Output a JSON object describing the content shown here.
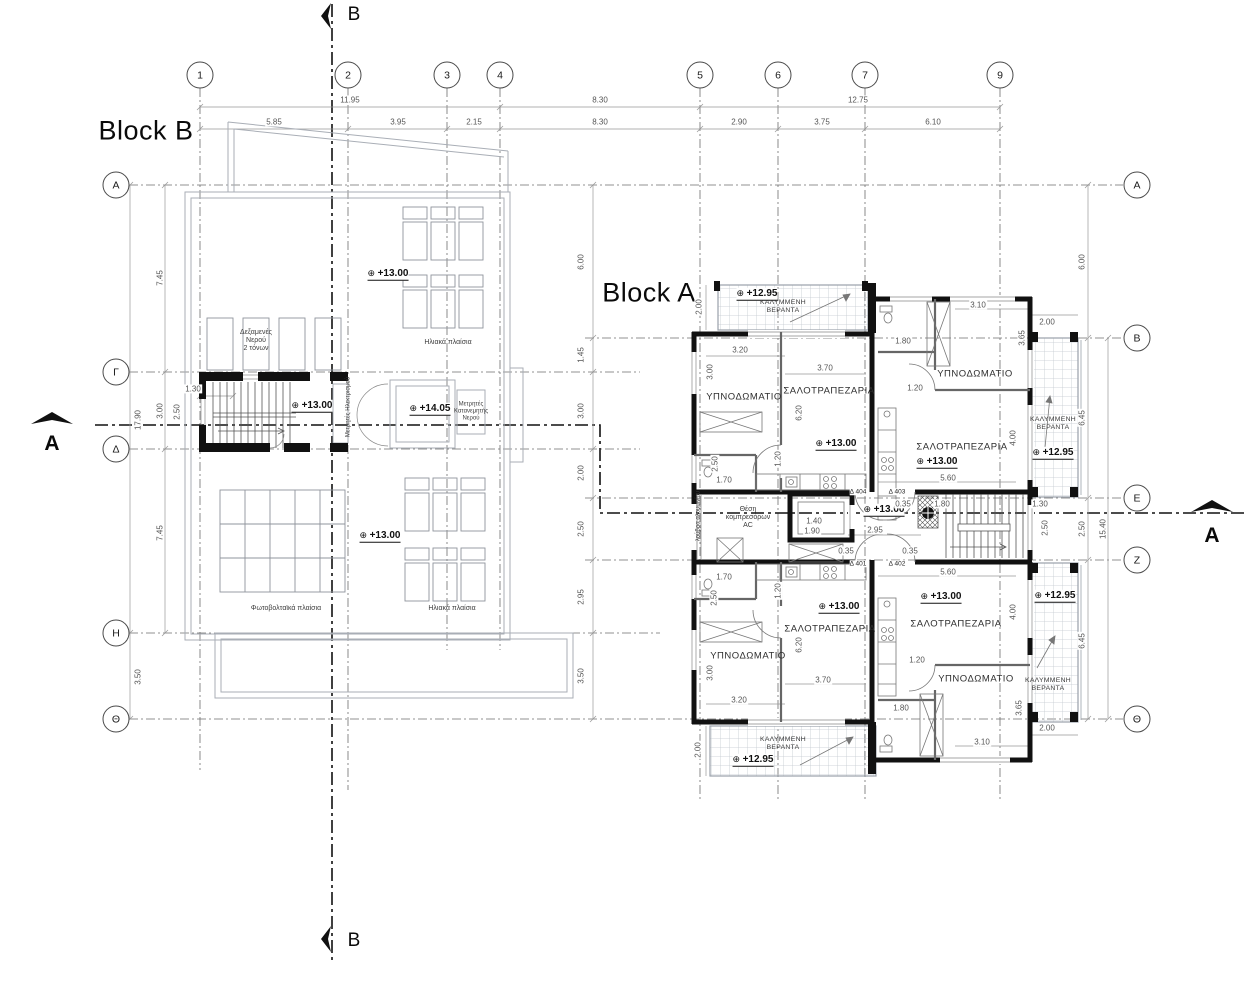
{
  "drawing": {
    "type": "roof / fourth floor plan",
    "line_color": "#4a4a4a",
    "wall_color": "#111111",
    "hatch_color": "#c3c9d0"
  },
  "titles": [
    {
      "t": "Block B",
      "x": 146,
      "y": 131,
      "cls": "big"
    },
    {
      "t": "Block A",
      "x": 649,
      "y": 293,
      "cls": "big"
    }
  ],
  "section_letters": [
    {
      "t": "B",
      "x": 354,
      "y": 15,
      "cls": "sec"
    },
    {
      "t": "B",
      "x": 354,
      "y": 941,
      "cls": "sec"
    },
    {
      "t": "A",
      "x": 52,
      "y": 444,
      "cls": "sec secb"
    },
    {
      "t": "A",
      "x": 1212,
      "y": 536,
      "cls": "sec secb"
    }
  ],
  "grid": {
    "columns": [
      {
        "label": "1",
        "x": 200
      },
      {
        "label": "2",
        "x": 348
      },
      {
        "label": "3",
        "x": 447
      },
      {
        "label": "4",
        "x": 500
      },
      {
        "label": "5",
        "x": 700
      },
      {
        "label": "6",
        "x": 778
      },
      {
        "label": "7",
        "x": 865
      },
      {
        "label": "9",
        "x": 1000
      }
    ],
    "rows_left": [
      {
        "label": "A",
        "y": 185
      },
      {
        "label": "Γ",
        "y": 372
      },
      {
        "label": "Δ",
        "y": 449
      },
      {
        "label": "H",
        "y": 633
      },
      {
        "label": "Θ",
        "y": 719
      }
    ],
    "rows_right": [
      {
        "label": "A",
        "y": 185
      },
      {
        "label": "B",
        "y": 338
      },
      {
        "label": "E",
        "y": 498
      },
      {
        "label": "Z",
        "y": 560
      },
      {
        "label": "Θ",
        "y": 719
      }
    ]
  },
  "labels": [
    {
      "t": "11.95",
      "x": 350,
      "y": 100,
      "cls": "dim"
    },
    {
      "t": "8.30",
      "x": 600,
      "y": 100,
      "cls": "dim"
    },
    {
      "t": "12.75",
      "x": 858,
      "y": 100,
      "cls": "dim"
    },
    {
      "t": "5.85",
      "x": 274,
      "y": 122,
      "cls": "dim"
    },
    {
      "t": "3.95",
      "x": 398,
      "y": 122,
      "cls": "dim"
    },
    {
      "t": "2.15",
      "x": 474,
      "y": 122,
      "cls": "dim"
    },
    {
      "t": "8.30",
      "x": 600,
      "y": 122,
      "cls": "dim"
    },
    {
      "t": "2.90",
      "x": 739,
      "y": 122,
      "cls": "dim"
    },
    {
      "t": "3.75",
      "x": 822,
      "y": 122,
      "cls": "dim"
    },
    {
      "t": "6.10",
      "x": 933,
      "y": 122,
      "cls": "dim"
    },
    {
      "t": "17.90",
      "x": 138,
      "y": 420,
      "cls": "dim dimv"
    },
    {
      "t": "3.50",
      "x": 138,
      "y": 677,
      "cls": "dim dimv"
    },
    {
      "t": "7.45",
      "x": 160,
      "y": 278,
      "cls": "dim dimv"
    },
    {
      "t": "3.00",
      "x": 160,
      "y": 411,
      "cls": "dim dimv"
    },
    {
      "t": "2.50",
      "x": 177,
      "y": 412,
      "cls": "dim dimv"
    },
    {
      "t": "7.45",
      "x": 160,
      "y": 533,
      "cls": "dim dimv"
    },
    {
      "t": "1.30",
      "x": 193,
      "y": 389,
      "cls": "dim"
    },
    {
      "t": "6.00",
      "x": 581,
      "y": 262,
      "cls": "dim dimv"
    },
    {
      "t": "1.45",
      "x": 581,
      "y": 355,
      "cls": "dim dimv"
    },
    {
      "t": "3.00",
      "x": 581,
      "y": 411,
      "cls": "dim dimv"
    },
    {
      "t": "2.00",
      "x": 581,
      "y": 473,
      "cls": "dim dimv"
    },
    {
      "t": "2.50",
      "x": 581,
      "y": 529,
      "cls": "dim dimv"
    },
    {
      "t": "2.95",
      "x": 581,
      "y": 597,
      "cls": "dim dimv"
    },
    {
      "t": "3.50",
      "x": 581,
      "y": 676,
      "cls": "dim dimv"
    },
    {
      "t": "6.00",
      "x": 1082,
      "y": 262,
      "cls": "dim dimv"
    },
    {
      "t": "6.45",
      "x": 1082,
      "y": 418,
      "cls": "dim dimv"
    },
    {
      "t": "2.50",
      "x": 1082,
      "y": 529,
      "cls": "dim dimv"
    },
    {
      "t": "6.45",
      "x": 1082,
      "y": 641,
      "cls": "dim dimv"
    },
    {
      "t": "15.40",
      "x": 1103,
      "y": 529,
      "cls": "dim dimv"
    },
    {
      "t": "Δεξαμενές\nΝερού\n2 τόνων",
      "x": 256,
      "y": 341,
      "cls": "note"
    },
    {
      "t": "Ηλιακά πλαίσια",
      "x": 448,
      "y": 343,
      "cls": "note"
    },
    {
      "t": "Ηλιακά πλαίσια",
      "x": 452,
      "y": 609,
      "cls": "note"
    },
    {
      "t": "Φωτοβολταϊκά πλαίσια",
      "x": 286,
      "y": 609,
      "cls": "note"
    },
    {
      "t": "Μετρητές\nΚατανεμητής\nΝερού",
      "x": 471,
      "y": 412,
      "cls": "note sm"
    },
    {
      "t": "Μετρητές Ηλεκτρισμού",
      "x": 349,
      "y": 407,
      "cls": "notev"
    },
    {
      "t": "+13.00",
      "x": 388,
      "y": 274,
      "cls": "level"
    },
    {
      "t": "+13.00",
      "x": 312,
      "y": 406,
      "cls": "level"
    },
    {
      "t": "+14.05",
      "x": 430,
      "y": 409,
      "cls": "level"
    },
    {
      "t": "+13.00",
      "x": 380,
      "y": 536,
      "cls": "level"
    },
    {
      "t": "ΥΠΝΟΔΩΜΑΤΙΟ",
      "x": 744,
      "y": 398,
      "cls": "room"
    },
    {
      "t": "ΣΑΛΟΤΡΑΠΕΖΑΡΙΑ",
      "x": 829,
      "y": 392,
      "cls": "room"
    },
    {
      "t": "ΥΠΝΟΔΩΜΑΤΙΟ",
      "x": 975,
      "y": 375,
      "cls": "room"
    },
    {
      "t": "ΣΑΛΟΤΡΑΠΕΖΑΡΙΑ",
      "x": 962,
      "y": 448,
      "cls": "room"
    },
    {
      "t": "ΥΠΝΟΔΩΜΑΤΙΟ",
      "x": 748,
      "y": 657,
      "cls": "room"
    },
    {
      "t": "ΣΑΛΟΤΡΑΠΕΖΑΡΙΑ",
      "x": 830,
      "y": 630,
      "cls": "room"
    },
    {
      "t": "ΥΠΝΟΔΩΜΑΤΙΟ",
      "x": 976,
      "y": 680,
      "cls": "room"
    },
    {
      "t": "ΣΑΛΟΤΡΑΠΕΖΑΡΙΑ",
      "x": 956,
      "y": 625,
      "cls": "room"
    },
    {
      "t": "ΚΑΛΥΜΜΕΝΗ\nΒΕΡΑΝΤΑ",
      "x": 783,
      "y": 307,
      "cls": "ver"
    },
    {
      "t": "ΚΑΛΥΜΜΕΝΗ\nΒΕΡΑΝΤΑ",
      "x": 783,
      "y": 744,
      "cls": "ver"
    },
    {
      "t": "ΚΑΛΥΜΜΕΝΗ\nΒΕΡΑΝΤΑ",
      "x": 1053,
      "y": 424,
      "cls": "ver"
    },
    {
      "t": "ΚΑΛΥΜΜΕΝΗ\nΒΕΡΑΝΤΑ",
      "x": 1048,
      "y": 685,
      "cls": "ver"
    },
    {
      "t": "Θέση\nκομπρεσόρων\nAC",
      "x": 748,
      "y": 518,
      "cls": "note"
    },
    {
      "t": "λούβρα αλουμινίου",
      "x": 699,
      "y": 516,
      "cls": "notev"
    },
    {
      "t": "Δ 404",
      "x": 858,
      "y": 492,
      "cls": "door"
    },
    {
      "t": "Δ 403",
      "x": 897,
      "y": 492,
      "cls": "door"
    },
    {
      "t": "Δ 401",
      "x": 858,
      "y": 564,
      "cls": "door"
    },
    {
      "t": "Δ 402",
      "x": 897,
      "y": 564,
      "cls": "door"
    },
    {
      "t": "+12.95",
      "x": 757,
      "y": 294,
      "cls": "level"
    },
    {
      "t": "+13.00",
      "x": 836,
      "y": 444,
      "cls": "level"
    },
    {
      "t": "+13.00",
      "x": 937,
      "y": 462,
      "cls": "level"
    },
    {
      "t": "+12.95",
      "x": 1053,
      "y": 453,
      "cls": "level"
    },
    {
      "t": "+13.00",
      "x": 884,
      "y": 510,
      "cls": "level"
    },
    {
      "t": "+13.00",
      "x": 839,
      "y": 607,
      "cls": "level"
    },
    {
      "t": "+13.00",
      "x": 941,
      "y": 597,
      "cls": "level"
    },
    {
      "t": "+12.95",
      "x": 753,
      "y": 760,
      "cls": "level"
    },
    {
      "t": "+12.95",
      "x": 1055,
      "y": 596,
      "cls": "level"
    },
    {
      "t": "2.00",
      "x": 699,
      "y": 307,
      "cls": "dim dimv"
    },
    {
      "t": "3.20",
      "x": 740,
      "y": 350,
      "cls": "dim"
    },
    {
      "t": "3.70",
      "x": 825,
      "y": 368,
      "cls": "dim"
    },
    {
      "t": "3.00",
      "x": 710,
      "y": 372,
      "cls": "dim dimv"
    },
    {
      "t": "6.20",
      "x": 799,
      "y": 413,
      "cls": "dim dimv"
    },
    {
      "t": "1.20",
      "x": 778,
      "y": 459,
      "cls": "dim dimv"
    },
    {
      "t": "2.50",
      "x": 715,
      "y": 464,
      "cls": "dim dimv"
    },
    {
      "t": "1.70",
      "x": 724,
      "y": 480,
      "cls": "dim"
    },
    {
      "t": "1.80",
      "x": 903,
      "y": 341,
      "cls": "dim"
    },
    {
      "t": "3.10",
      "x": 978,
      "y": 305,
      "cls": "dim"
    },
    {
      "t": "3.65",
      "x": 1022,
      "y": 338,
      "cls": "dim dimv"
    },
    {
      "t": "1.20",
      "x": 915,
      "y": 388,
      "cls": "dim"
    },
    {
      "t": "4.00",
      "x": 1013,
      "y": 438,
      "cls": "dim dimv"
    },
    {
      "t": "5.60",
      "x": 948,
      "y": 478,
      "cls": "dim"
    },
    {
      "t": "2.00",
      "x": 1047,
      "y": 322,
      "cls": "dim"
    },
    {
      "t": "1.40",
      "x": 814,
      "y": 521,
      "cls": "dim"
    },
    {
      "t": "1.90",
      "x": 812,
      "y": 531,
      "cls": "dim"
    },
    {
      "t": "2.95",
      "x": 875,
      "y": 530,
      "cls": "dim"
    },
    {
      "t": "0.35",
      "x": 903,
      "y": 504,
      "cls": "dim"
    },
    {
      "t": "1.80",
      "x": 942,
      "y": 504,
      "cls": "dim"
    },
    {
      "t": "0.35",
      "x": 846,
      "y": 551,
      "cls": "dim"
    },
    {
      "t": "0.35",
      "x": 910,
      "y": 551,
      "cls": "dim"
    },
    {
      "t": "1.30",
      "x": 1040,
      "y": 504,
      "cls": "dim"
    },
    {
      "t": "2.50",
      "x": 1045,
      "y": 528,
      "cls": "dim dimv"
    },
    {
      "t": "5.60",
      "x": 948,
      "y": 572,
      "cls": "dim"
    },
    {
      "t": "1.70",
      "x": 724,
      "y": 577,
      "cls": "dim"
    },
    {
      "t": "1.20",
      "x": 778,
      "y": 591,
      "cls": "dim dimv"
    },
    {
      "t": "2.50",
      "x": 714,
      "y": 598,
      "cls": "dim dimv"
    },
    {
      "t": "6.20",
      "x": 799,
      "y": 645,
      "cls": "dim dimv"
    },
    {
      "t": "3.70",
      "x": 823,
      "y": 680,
      "cls": "dim"
    },
    {
      "t": "3.20",
      "x": 739,
      "y": 700,
      "cls": "dim"
    },
    {
      "t": "3.00",
      "x": 710,
      "y": 673,
      "cls": "dim dimv"
    },
    {
      "t": "2.00",
      "x": 698,
      "y": 750,
      "cls": "dim dimv"
    },
    {
      "t": "1.20",
      "x": 917,
      "y": 660,
      "cls": "dim"
    },
    {
      "t": "1.80",
      "x": 901,
      "y": 708,
      "cls": "dim"
    },
    {
      "t": "4.00",
      "x": 1013,
      "y": 612,
      "cls": "dim dimv"
    },
    {
      "t": "3.65",
      "x": 1019,
      "y": 708,
      "cls": "dim dimv"
    },
    {
      "t": "3.10",
      "x": 982,
      "y": 742,
      "cls": "dim"
    },
    {
      "t": "2.00",
      "x": 1047,
      "y": 728,
      "cls": "dim"
    }
  ]
}
